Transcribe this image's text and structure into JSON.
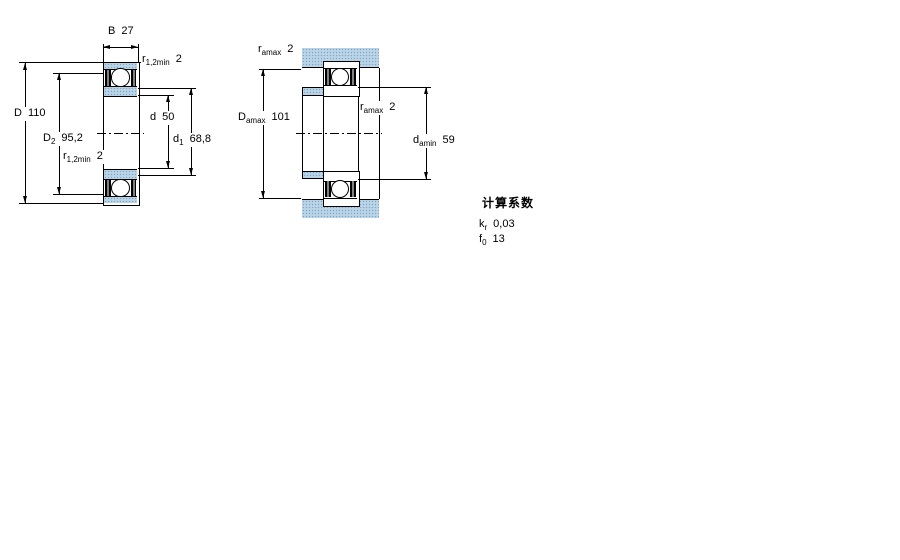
{
  "left_figure": {
    "dims": {
      "B": {
        "sym": "B",
        "sub": "",
        "value": "27"
      },
      "r12_top": {
        "sym": "r",
        "sub": "1,2min",
        "value": "2"
      },
      "D": {
        "sym": "D",
        "sub": "",
        "value": "110"
      },
      "D2": {
        "sym": "D",
        "sub": "2",
        "value": "95,2"
      },
      "r12_bottom": {
        "sym": "r",
        "sub": "1,2min",
        "value": "2"
      },
      "d": {
        "sym": "d",
        "sub": "",
        "value": "50"
      },
      "d1": {
        "sym": "d",
        "sub": "1",
        "value": "68,8"
      }
    }
  },
  "right_figure": {
    "dims": {
      "ra_top": {
        "sym": "r",
        "sub": "amax",
        "value": "2"
      },
      "Damax": {
        "sym": "D",
        "sub": "amax",
        "value": "101"
      },
      "ra_mid": {
        "sym": "r",
        "sub": "amax",
        "value": "2"
      },
      "damin": {
        "sym": "d",
        "sub": "amin",
        "value": "59"
      }
    }
  },
  "calculation_factors": {
    "title": "计算系数",
    "rows": [
      {
        "sym": "k",
        "sub": "r",
        "value": "0,03"
      },
      {
        "sym": "f",
        "sub": "0",
        "value": "13"
      }
    ]
  },
  "colors": {
    "section_fill": "#b9d3e7",
    "section_dot": "#7da3c0",
    "line": "#000000",
    "background": "#ffffff"
  }
}
